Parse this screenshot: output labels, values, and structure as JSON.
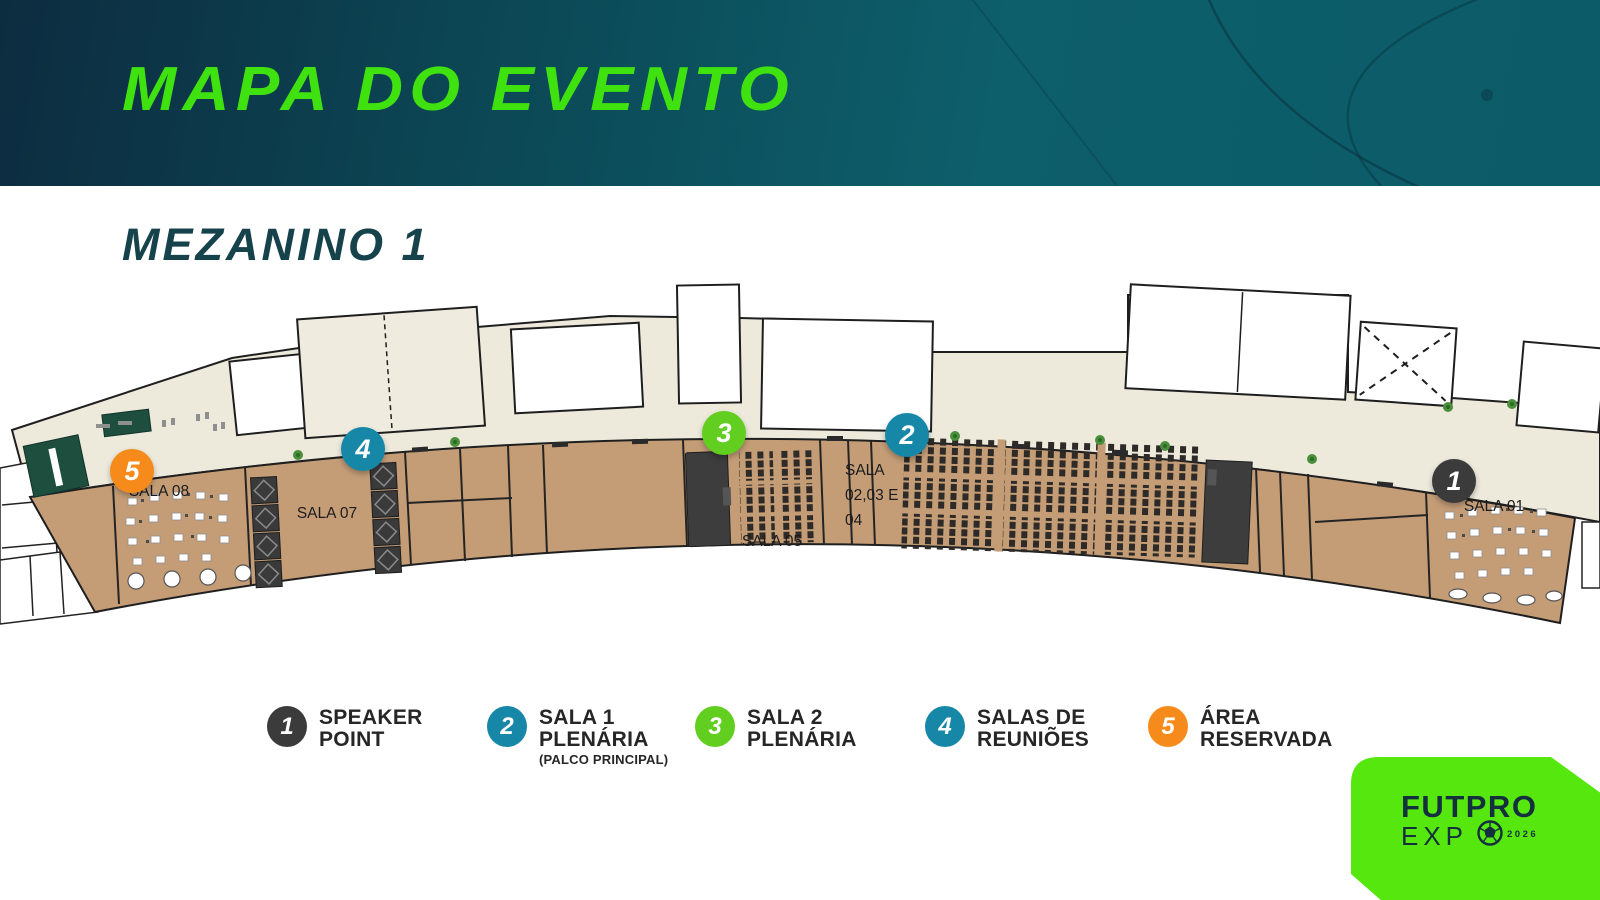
{
  "colors": {
    "title_green": "#3fe20f",
    "header_teal": "#0d5f6b",
    "marker_dark": "#3b3b3b",
    "marker_teal": "#1787a8",
    "marker_green": "#62ce1f",
    "marker_orange": "#f68b1c",
    "logo_green": "#55e70e",
    "logo_navy": "#142f3e",
    "floor_cream": "#edeadc",
    "floor_brown": "#c49d77"
  },
  "header": {
    "title": "MAPA DO EVENTO"
  },
  "floor": {
    "title": "MEZANINO 1"
  },
  "map": {
    "markers": [
      {
        "number": "1",
        "color": "#3b3b3b"
      },
      {
        "number": "2",
        "color": "#1787a8"
      },
      {
        "number": "3",
        "color": "#62ce1f"
      },
      {
        "number": "4",
        "color": "#1787a8"
      },
      {
        "number": "5",
        "color": "#f68b1c"
      }
    ],
    "labels": {
      "sala08": "SALA 08",
      "sala07": "SALA 07",
      "sala05": "SALA 05",
      "sala0204_l1": "SALA",
      "sala0204_l2": "02,03 E",
      "sala0204_l3": "04",
      "sala01": "SALA 01"
    }
  },
  "legend": {
    "items": [
      {
        "number": "1",
        "color": "#3b3b3b",
        "line1": "SPEAKER",
        "line2": "POINT",
        "note": ""
      },
      {
        "number": "2",
        "color": "#1787a8",
        "line1": "SALA 1",
        "line2": "PLENÁRIA",
        "note": "(PALCO PRINCIPAL)"
      },
      {
        "number": "3",
        "color": "#62ce1f",
        "line1": "SALA 2",
        "line2": "PLENÁRIA",
        "note": ""
      },
      {
        "number": "4",
        "color": "#1787a8",
        "line1": "SALAS DE",
        "line2": "REUNIÕES",
        "note": ""
      },
      {
        "number": "5",
        "color": "#f68b1c",
        "line1": "ÁREA",
        "line2": "RESERVADA",
        "note": ""
      }
    ]
  },
  "logo": {
    "brand_line1": "FUTPRO",
    "brand_line2": "EXP",
    "year": "2026"
  }
}
